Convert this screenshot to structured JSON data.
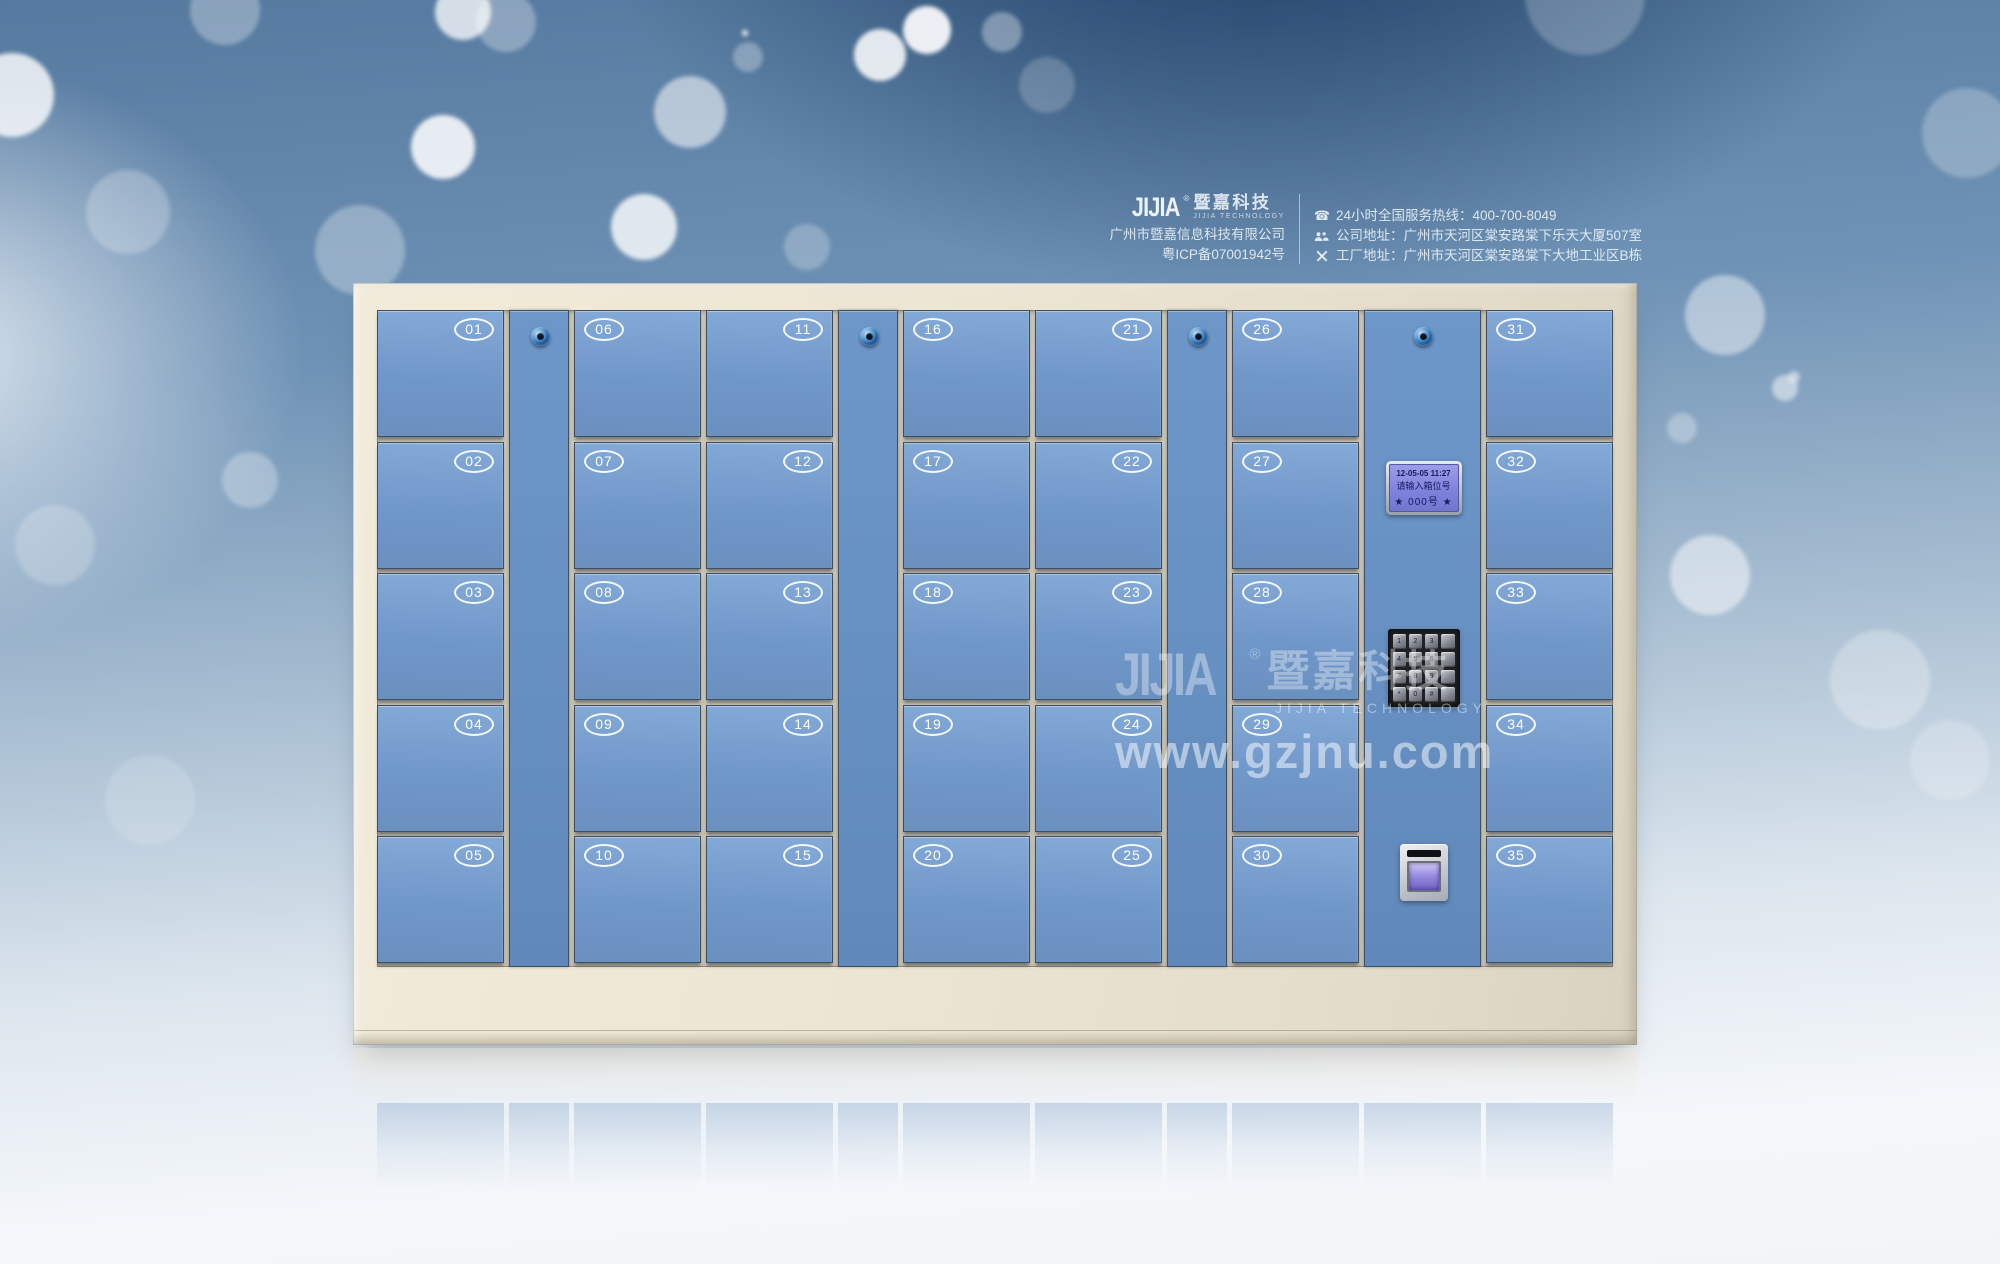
{
  "header": {
    "logo": {
      "mark": "JIJIA",
      "reg": "®",
      "cn": "暨嘉科技",
      "en": "JIJIA TECHNOLOGY"
    },
    "company": "广州市暨嘉信息科技有限公司",
    "icp": "粤ICP备07001942号",
    "contacts": [
      {
        "icon": "phone-icon",
        "text": "24小时全国服务热线：400-700-8049"
      },
      {
        "icon": "people-icon",
        "text": "公司地址：广州市天河区棠安路棠下乐天大厦507室"
      },
      {
        "icon": "tools-icon",
        "text": "工厂地址：广州市天河区棠安路棠下大地工业区B栋"
      }
    ]
  },
  "watermark": {
    "mark": "JIJIA",
    "reg": "®",
    "cn": "暨嘉科技",
    "en": "JIJIA TECHNOLOGY",
    "url": "www.gzjnu.com"
  },
  "locker": {
    "columns": [
      {
        "type": "doors",
        "numbers": [
          "01",
          "02",
          "03",
          "04",
          "05"
        ],
        "number_side": "right"
      },
      {
        "type": "lock"
      },
      {
        "type": "doors",
        "numbers": [
          "06",
          "07",
          "08",
          "09",
          "10"
        ],
        "number_side": "left"
      },
      {
        "type": "doors",
        "numbers": [
          "11",
          "12",
          "13",
          "14",
          "15"
        ],
        "number_side": "right"
      },
      {
        "type": "lock"
      },
      {
        "type": "doors",
        "numbers": [
          "16",
          "17",
          "18",
          "19",
          "20"
        ],
        "number_side": "left"
      },
      {
        "type": "doors",
        "numbers": [
          "21",
          "22",
          "23",
          "24",
          "25"
        ],
        "number_side": "right"
      },
      {
        "type": "lock"
      },
      {
        "type": "doors",
        "numbers": [
          "26",
          "27",
          "28",
          "29",
          "30"
        ],
        "number_side": "left"
      },
      {
        "type": "control"
      },
      {
        "type": "doors",
        "numbers": [
          "31",
          "32",
          "33",
          "34",
          "35"
        ],
        "number_side": "left"
      }
    ],
    "control": {
      "lcd": {
        "line1": "12-05-05 11:27",
        "line2": "请输入箱位号",
        "line3": "★ 000号 ★"
      },
      "keypad": [
        [
          "1",
          "2",
          "3",
          ""
        ],
        [
          "4",
          "5",
          "6",
          ""
        ],
        [
          "7",
          "8",
          "9",
          ""
        ],
        [
          "*",
          "0",
          "#",
          ""
        ]
      ]
    }
  },
  "colors": {
    "door_blue": "#7097c9",
    "frame_cream": "#ece5d3",
    "lcd_purple": "#8184dc",
    "background_navy": "#1f4268",
    "badge_white": "#ffffff"
  },
  "background": {
    "bokeh_xyro": [
      [
        12,
        95,
        42,
        0.8
      ],
      [
        225,
        10,
        35,
        0.3
      ],
      [
        128,
        212,
        42,
        0.25
      ],
      [
        55,
        545,
        40,
        0.22
      ],
      [
        250,
        480,
        28,
        0.3
      ],
      [
        150,
        800,
        45,
        0.15
      ],
      [
        360,
        250,
        45,
        0.3
      ],
      [
        463,
        12,
        28,
        0.75
      ],
      [
        506,
        22,
        30,
        0.3
      ],
      [
        443,
        147,
        32,
        0.85
      ],
      [
        644,
        227,
        33,
        0.8
      ],
      [
        690,
        112,
        36,
        0.55
      ],
      [
        745,
        33,
        3,
        0.9
      ],
      [
        748,
        57,
        15,
        0.3
      ],
      [
        807,
        247,
        23,
        0.25
      ],
      [
        880,
        55,
        26,
        0.85
      ],
      [
        927,
        30,
        24,
        0.9
      ],
      [
        1002,
        32,
        20,
        0.35
      ],
      [
        1047,
        85,
        28,
        0.2
      ],
      [
        1585,
        -5,
        60,
        0.22
      ],
      [
        1967,
        133,
        45,
        0.25
      ],
      [
        1725,
        315,
        40,
        0.45
      ],
      [
        1794,
        377,
        6,
        0.5
      ],
      [
        1785,
        388,
        13,
        0.5
      ],
      [
        1682,
        428,
        15,
        0.3
      ],
      [
        1710,
        575,
        40,
        0.5
      ],
      [
        1880,
        680,
        50,
        0.28
      ],
      [
        1950,
        760,
        40,
        0.2
      ]
    ]
  }
}
